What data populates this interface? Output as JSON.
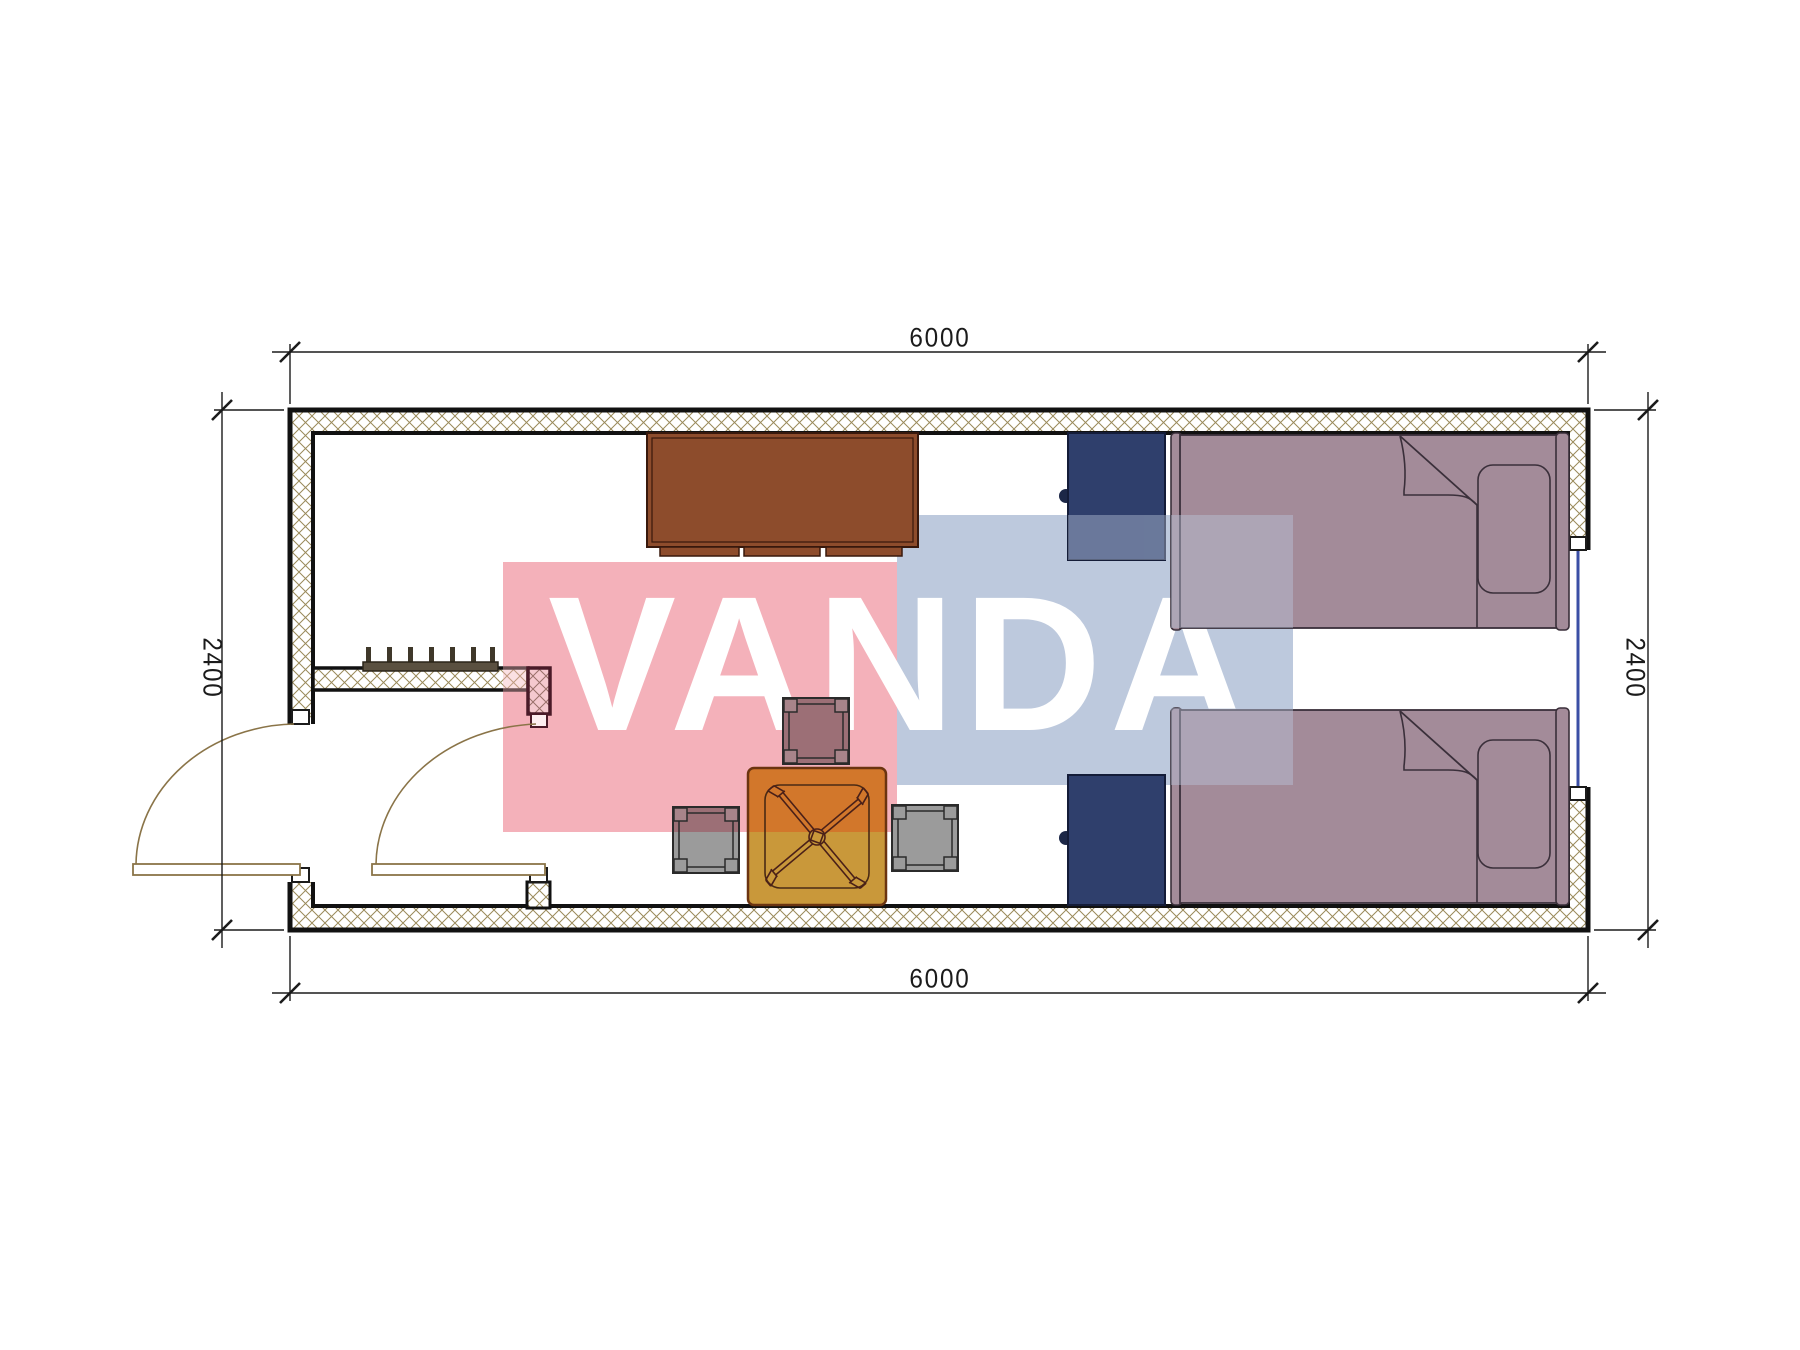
{
  "title": "container-room-floor-plan",
  "watermark": {
    "text": "VANDA",
    "pink_color": "#f4b1ba",
    "blue_color": "#bdc9dd",
    "text_color": "#ffffff"
  },
  "dimensions": {
    "top": "6000",
    "bottom": "6000",
    "left": "2400",
    "right": "2400"
  },
  "colors": {
    "wall_hatch_line": "#9a8a5a",
    "wall_outline": "#111111",
    "cabinet": "#8d4c2c",
    "nightstand": "#2f3f6c",
    "bed": "#a38b99",
    "table_tinted": "#d2772b",
    "table_plain": "#c9983a",
    "stool_plain": "#9b9b9b",
    "stool_tinted": "#9c6f76",
    "door_arc": "#8a7448",
    "window_glazing": "#3b4fa5"
  },
  "furniture": {
    "cabinet": "sideboard-cabinet",
    "nightstands": [
      "nightstand-top",
      "nightstand-bottom"
    ],
    "beds": [
      "single-bed-top",
      "single-bed-bottom"
    ],
    "table": "square-table-with-chair",
    "stools": [
      "stool-top",
      "stool-left",
      "stool-right"
    ],
    "radiator": "wall-radiator",
    "doors": [
      "entry-door-left",
      "interior-door"
    ],
    "window": "window-right-wall"
  }
}
